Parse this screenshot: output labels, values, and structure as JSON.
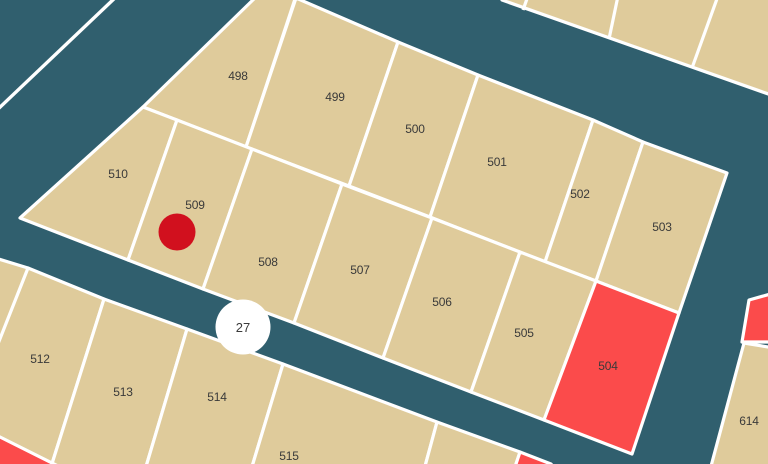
{
  "map": {
    "type": "cadastral-parcel-map",
    "colors": {
      "road_background": "#305F6E",
      "parcel_fill": "#DFCB9B",
      "parcel_border": "#FFFFFF",
      "highlighted_parcel_fill": "#FB4B4B",
      "marker_dot": "#D1101E",
      "road_badge_background": "#FFFFFF",
      "label_text": "#3A3A3A"
    },
    "road_marker": {
      "label": "27"
    },
    "point_marker": {
      "shape": "dot",
      "color": "#D1101E",
      "located_on_parcel": "509"
    },
    "parcels": [
      {
        "label": "498",
        "highlighted": false
      },
      {
        "label": "499",
        "highlighted": false
      },
      {
        "label": "500",
        "highlighted": false
      },
      {
        "label": "501",
        "highlighted": false
      },
      {
        "label": "502",
        "highlighted": false
      },
      {
        "label": "503",
        "highlighted": false
      },
      {
        "label": "510",
        "highlighted": false
      },
      {
        "label": "509",
        "highlighted": false
      },
      {
        "label": "508",
        "highlighted": false
      },
      {
        "label": "507",
        "highlighted": false
      },
      {
        "label": "506",
        "highlighted": false
      },
      {
        "label": "505",
        "highlighted": false
      },
      {
        "label": "504",
        "highlighted": true
      },
      {
        "label": "512",
        "highlighted": false
      },
      {
        "label": "513",
        "highlighted": false
      },
      {
        "label": "514",
        "highlighted": false
      },
      {
        "label": "515",
        "highlighted": false
      },
      {
        "label": "614",
        "highlighted": false
      },
      {
        "label": "",
        "highlighted": true
      },
      {
        "label": "",
        "highlighted": true
      },
      {
        "label": "",
        "highlighted": true
      }
    ]
  }
}
